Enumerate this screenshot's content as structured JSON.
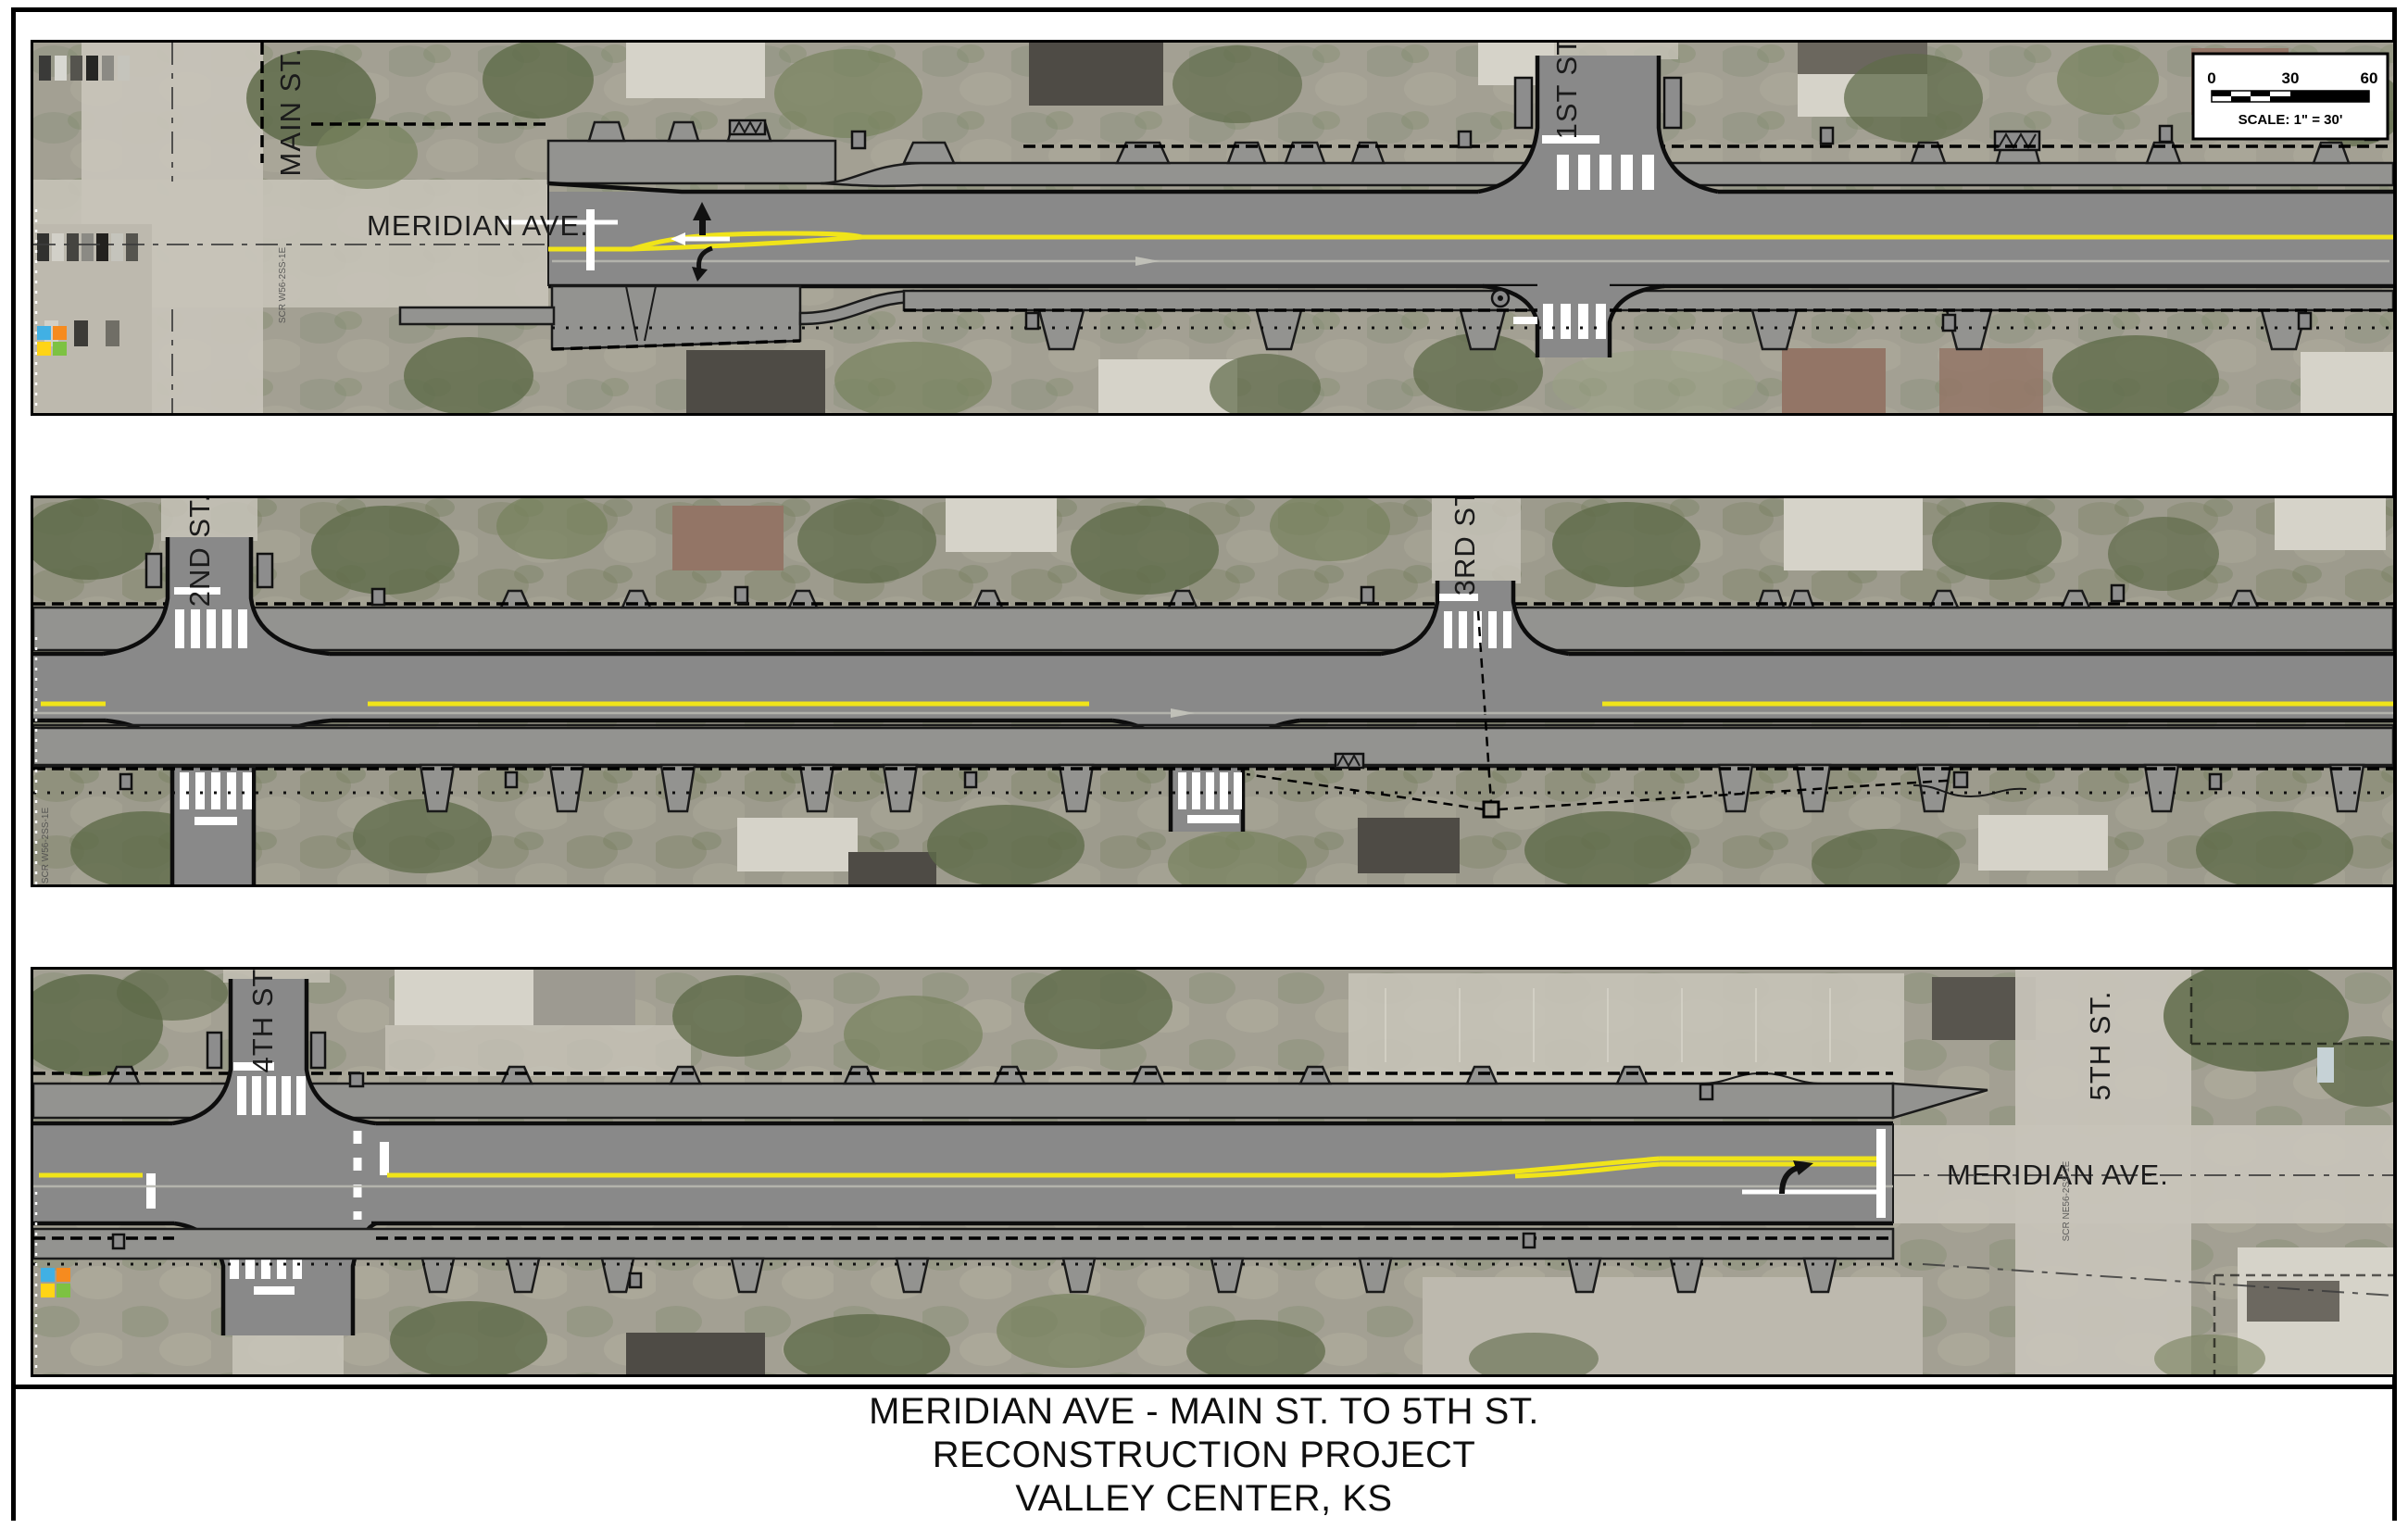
{
  "title_block": {
    "line1": "MERIDIAN AVE - MAIN ST. TO 5TH ST.",
    "line2": "RECONSTRUCTION PROJECT",
    "line3": "VALLEY CENTER, KS"
  },
  "scale_bar": {
    "tick_0": "0",
    "tick_30": "30",
    "tick_60": "60",
    "caption": "SCALE: 1\" = 30'"
  },
  "panels": {
    "panel1": {
      "labels": {
        "main_st": "MAIN ST.",
        "meridian_ave": "MERIDIAN AVE.",
        "first_st": "1ST ST."
      },
      "survey_ref": "SCR W56-2SS-1E"
    },
    "panel2": {
      "labels": {
        "second_st": "2ND ST.",
        "third_st": "3RD ST."
      },
      "survey_ref": "SCR W56-2SS-1E"
    },
    "panel3": {
      "labels": {
        "fourth_st": "4TH ST.",
        "fifth_st": "5TH ST.",
        "meridian_ave": "MERIDIAN AVE."
      },
      "survey_ref": "SCR NE56-2SS-1E"
    }
  },
  "colors": {
    "pavement_gray": "#898989",
    "sidewalk_gray": "#939390",
    "centerline_yellow": "#f0e41a",
    "marking_white": "#ffffff",
    "linework_black": "#141414",
    "logo_blue": "#41b0e4",
    "logo_orange": "#f68b1f",
    "logo_yellow": "#ffd416",
    "logo_green": "#7dc242"
  }
}
